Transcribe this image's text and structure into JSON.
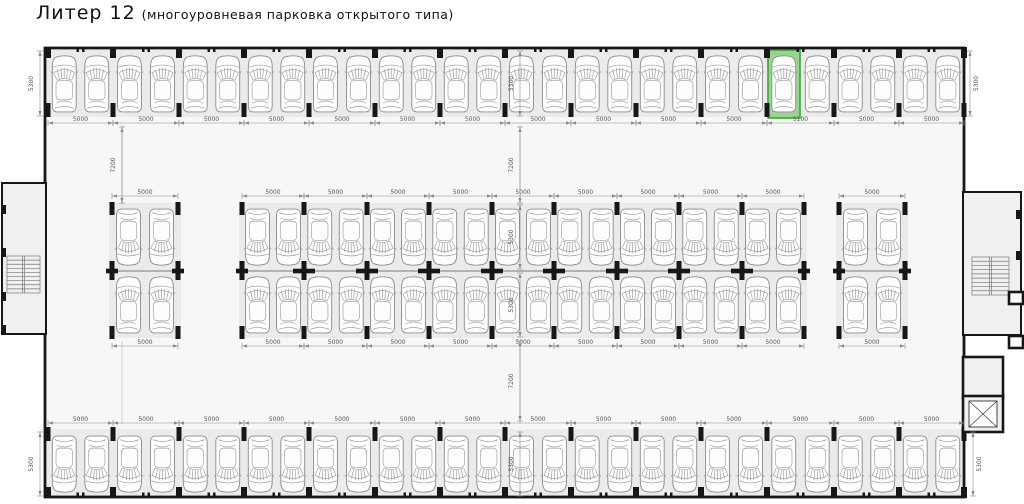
{
  "title": {
    "main": "Литер 12",
    "sub": "(многоуровневая парковка открытого типа)"
  },
  "colors": {
    "highlight_fill": "#98d690",
    "highlight_stroke": "#3ba33b",
    "floor": "#f7f7f8",
    "row_strip": "#ebebed",
    "annex_floor": "#f0f0f1",
    "wall": "#171717",
    "divider": "#7a7a7a"
  },
  "dims": {
    "standard_bay": "5000",
    "highlight_bay": "5100",
    "row_depth": "5300",
    "aisle_width": "7200"
  },
  "plan": {
    "building": {
      "x": 45,
      "y": 48,
      "w": 919,
      "h": 449
    },
    "rows": [
      {
        "id": "top-wall-row",
        "kind": "wall-top",
        "car_y": 52,
        "facing": "up",
        "dim_y": 123,
        "bays": [
          {
            "x": 48,
            "w": 65,
            "label": "5000"
          },
          {
            "x": 113,
            "w": 66,
            "label": "5000"
          },
          {
            "x": 179,
            "w": 65,
            "label": "5000"
          },
          {
            "x": 244,
            "w": 65,
            "label": "5000"
          },
          {
            "x": 309,
            "w": 66,
            "label": "5000"
          },
          {
            "x": 375,
            "w": 65,
            "label": "5000"
          },
          {
            "x": 440,
            "w": 65,
            "label": "5000"
          },
          {
            "x": 505,
            "w": 66,
            "label": "5000"
          },
          {
            "x": 571,
            "w": 65,
            "label": "5000"
          },
          {
            "x": 636,
            "w": 65,
            "label": "5000"
          },
          {
            "x": 701,
            "w": 66,
            "label": "5000"
          },
          {
            "x": 767,
            "w": 67,
            "label": "5100",
            "highlight": "left"
          },
          {
            "x": 834,
            "w": 65,
            "label": "5000"
          },
          {
            "x": 899,
            "w": 65,
            "label": "5000"
          }
        ]
      },
      {
        "id": "center-top-row",
        "kind": "center",
        "car_y": 205,
        "facing": "down",
        "dim_y": 196,
        "bays_ref": "center_bays"
      },
      {
        "id": "center-bottom-row",
        "kind": "center",
        "car_y": 273,
        "facing": "up",
        "dim_y": 346,
        "bays_ref": "center_bays"
      },
      {
        "id": "bottom-wall-row",
        "kind": "wall-bottom",
        "car_y": 432,
        "facing": "down",
        "dim_y": 423,
        "bays": [
          {
            "x": 48,
            "w": 65,
            "label": "5000"
          },
          {
            "x": 113,
            "w": 66,
            "label": "5000"
          },
          {
            "x": 179,
            "w": 65,
            "label": "5000"
          },
          {
            "x": 244,
            "w": 65,
            "label": "5000"
          },
          {
            "x": 309,
            "w": 66,
            "label": "5000"
          },
          {
            "x": 375,
            "w": 65,
            "label": "5000"
          },
          {
            "x": 440,
            "w": 65,
            "label": "5000"
          },
          {
            "x": 505,
            "w": 66,
            "label": "5000"
          },
          {
            "x": 571,
            "w": 65,
            "label": "5000"
          },
          {
            "x": 636,
            "w": 65,
            "label": "5000"
          },
          {
            "x": 701,
            "w": 66,
            "label": "5000"
          },
          {
            "x": 767,
            "w": 67,
            "label": "5000"
          },
          {
            "x": 834,
            "w": 65,
            "label": "5000"
          },
          {
            "x": 899,
            "w": 65,
            "label": "5000"
          }
        ]
      }
    ],
    "center_bays": [
      {
        "x": 112,
        "w": 66,
        "label": "5000"
      },
      {
        "x": 242,
        "w": 62,
        "label": "5000"
      },
      {
        "x": 304,
        "w": 63,
        "label": "5000"
      },
      {
        "x": 367,
        "w": 62,
        "label": "5000"
      },
      {
        "x": 429,
        "w": 63,
        "label": "5000"
      },
      {
        "x": 492,
        "w": 62,
        "label": "5000"
      },
      {
        "x": 554,
        "w": 63,
        "label": "5000"
      },
      {
        "x": 617,
        "w": 62,
        "label": "5000"
      },
      {
        "x": 679,
        "w": 63,
        "label": "5000"
      },
      {
        "x": 742,
        "w": 62,
        "label": "5000"
      },
      {
        "x": 839,
        "w": 66,
        "label": "5000"
      }
    ],
    "highlight": {
      "row": "top-wall-row",
      "bay_index": 11,
      "side": "left",
      "label": "5100"
    },
    "vdims": [
      {
        "x": 40,
        "y1": 51,
        "y2": 116,
        "label": "5300",
        "lx": 33
      },
      {
        "x": 40,
        "y1": 432,
        "y2": 496,
        "label": "5300",
        "lx": 33
      },
      {
        "x": 970,
        "y1": 51,
        "y2": 116,
        "label": "5300",
        "lx": 978
      },
      {
        "x": 973,
        "y1": 432,
        "y2": 496,
        "label": "5300",
        "lx": 981
      },
      {
        "x": 520,
        "y1": 51,
        "y2": 116,
        "label": "5300",
        "lx": 513
      },
      {
        "x": 520,
        "y1": 127,
        "y2": 203,
        "label": "7200",
        "lx": 513
      },
      {
        "x": 520,
        "y1": 205,
        "y2": 269,
        "label": "5300",
        "lx": 513
      },
      {
        "x": 520,
        "y1": 273,
        "y2": 337,
        "label": "5300",
        "lx": 513
      },
      {
        "x": 520,
        "y1": 341,
        "y2": 421,
        "label": "7200",
        "lx": 513
      },
      {
        "x": 520,
        "y1": 432,
        "y2": 496,
        "label": "5300",
        "lx": 513
      },
      {
        "x": 122,
        "y1": 127,
        "y2": 203,
        "label": "7200",
        "lx": 115
      }
    ],
    "grid_lines": [
      {
        "x": 122,
        "y1": 125,
        "y2": 205
      },
      {
        "x": 122,
        "y1": 341,
        "y2": 424
      },
      {
        "x": 520,
        "y1": 125,
        "y2": 205
      },
      {
        "x": 520,
        "y1": 341,
        "y2": 424
      }
    ],
    "annex_left": {
      "x": 2,
      "y": 183,
      "w": 44,
      "h": 151,
      "stairs": {
        "x": 7,
        "y": 256,
        "w": 33,
        "h": 37,
        "treads": 9
      }
    },
    "annex_right": {
      "x": 963,
      "y": 192,
      "w": 58,
      "h": 143,
      "stairs": {
        "x": 972,
        "y": 257,
        "w": 37,
        "h": 38,
        "treads": 9
      }
    },
    "elevator": {
      "room": {
        "x": 963,
        "y": 357,
        "w": 40,
        "h": 42
      },
      "shaft": {
        "x": 963,
        "y": 396,
        "w": 40,
        "h": 36
      },
      "cab": {
        "x": 969,
        "y": 401,
        "w": 28,
        "h": 26
      }
    },
    "wall_squares": [
      {
        "x": 1009,
        "y": 292,
        "w": 14,
        "h": 12
      },
      {
        "x": 1009,
        "y": 336,
        "w": 14,
        "h": 12
      }
    ]
  }
}
